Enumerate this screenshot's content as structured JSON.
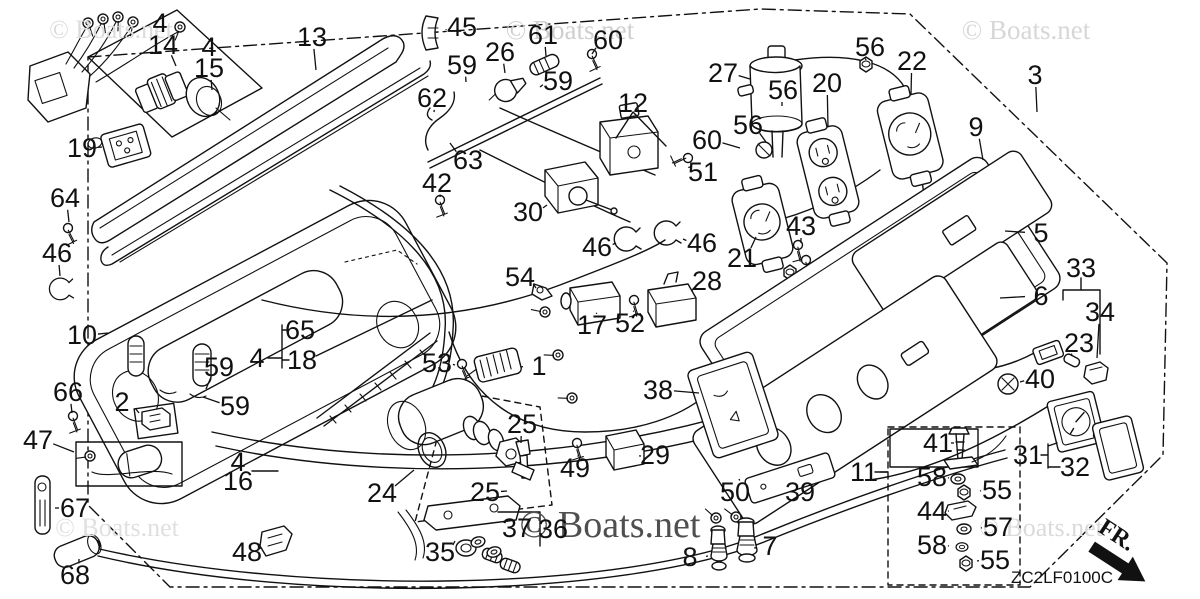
{
  "canvas": {
    "width": 1200,
    "height": 599,
    "background": "#ffffff",
    "ink_color": "#111111"
  },
  "watermarks": [
    {
      "text": "© Boats.net",
      "x": 111,
      "y": 38,
      "size": 26,
      "color": "#dcdcdc"
    },
    {
      "text": "© Boats.net",
      "x": 570,
      "y": 39,
      "size": 27,
      "color": "#cfcfcf"
    },
    {
      "text": "© Boats.net",
      "x": 1026,
      "y": 39,
      "size": 27,
      "color": "#d7d7d7"
    },
    {
      "text": "© Boats.net",
      "x": 117,
      "y": 536,
      "size": 26,
      "color": "#e0e0e0"
    },
    {
      "text": "© Boats.net",
      "x": 610,
      "y": 537,
      "size": 38,
      "color": "#4f4f4f"
    },
    {
      "text": "© Boats.net",
      "x": 1041,
      "y": 536,
      "size": 26,
      "color": "#dadada"
    }
  ],
  "footer": {
    "diagram_code": "ZC2LF0100C",
    "code_x": 1062,
    "code_y": 583,
    "fr_label": "FR.",
    "fr_x": 1097,
    "fr_y": 531,
    "fr_angle": 33
  },
  "part_labels": [
    {
      "t": "4",
      "x": 160,
      "y": 23
    },
    {
      "t": "14",
      "x": 163,
      "y": 45,
      "l": [
        176,
        66
      ]
    },
    {
      "t": "4",
      "x": 209,
      "y": 47
    },
    {
      "t": "15",
      "x": 209,
      "y": 68,
      "l": [
        212,
        90
      ]
    },
    {
      "t": "13",
      "x": 312,
      "y": 37,
      "l": [
        316,
        70
      ]
    },
    {
      "t": "45",
      "x": 462,
      "y": 27,
      "l": [
        446,
        30
      ]
    },
    {
      "t": "61",
      "x": 543,
      "y": 35,
      "l": [
        546,
        56
      ]
    },
    {
      "t": "60",
      "x": 608,
      "y": 40,
      "l": [
        592,
        54
      ]
    },
    {
      "t": "26",
      "x": 500,
      "y": 52,
      "l": [
        505,
        73
      ]
    },
    {
      "t": "59",
      "x": 462,
      "y": 65,
      "l": [
        466,
        82
      ]
    },
    {
      "t": "59",
      "x": 558,
      "y": 81,
      "l": [
        540,
        87
      ]
    },
    {
      "t": "27",
      "x": 723,
      "y": 73,
      "l": [
        750,
        79
      ]
    },
    {
      "t": "56",
      "x": 870,
      "y": 47,
      "l": [
        866,
        60
      ]
    },
    {
      "t": "22",
      "x": 912,
      "y": 61,
      "l": [
        911,
        94
      ]
    },
    {
      "t": "3",
      "x": 1035,
      "y": 75,
      "l": [
        1037,
        112
      ]
    },
    {
      "t": "20",
      "x": 827,
      "y": 83,
      "l": [
        828,
        127
      ]
    },
    {
      "t": "56",
      "x": 783,
      "y": 90,
      "l": [
        782,
        106
      ]
    },
    {
      "t": "62",
      "x": 432,
      "y": 98,
      "l": [
        434,
        112
      ]
    },
    {
      "t": "12",
      "x": 633,
      "y": 103
    },
    {
      "t": "56",
      "x": 748,
      "y": 125,
      "l": [
        766,
        142
      ]
    },
    {
      "t": "9",
      "x": 976,
      "y": 127,
      "l": [
        983,
        160
      ]
    },
    {
      "t": "60",
      "x": 707,
      "y": 140,
      "l": [
        740,
        148
      ]
    },
    {
      "t": "19",
      "x": 82,
      "y": 148,
      "l": [
        102,
        147
      ]
    },
    {
      "t": "63",
      "x": 468,
      "y": 160,
      "l": [
        450,
        143
      ]
    },
    {
      "t": "51",
      "x": 703,
      "y": 172,
      "l": [
        691,
        167
      ]
    },
    {
      "t": "42",
      "x": 437,
      "y": 183,
      "l": [
        440,
        197
      ]
    },
    {
      "t": "64",
      "x": 65,
      "y": 198,
      "l": [
        69,
        222
      ]
    },
    {
      "t": "30",
      "x": 528,
      "y": 212,
      "l": [
        547,
        205
      ]
    },
    {
      "t": "43",
      "x": 801,
      "y": 226,
      "l": [
        801,
        243
      ]
    },
    {
      "t": "5",
      "x": 1041,
      "y": 233,
      "l": [
        1005,
        231
      ]
    },
    {
      "t": "46",
      "x": 57,
      "y": 253,
      "l": [
        60,
        276
      ]
    },
    {
      "t": "46",
      "x": 597,
      "y": 247,
      "l": [
        616,
        243
      ]
    },
    {
      "t": "46",
      "x": 702,
      "y": 243,
      "l": [
        683,
        239
      ]
    },
    {
      "t": "21",
      "x": 742,
      "y": 258,
      "l": [
        756,
        237
      ]
    },
    {
      "t": "33",
      "x": 1081,
      "y": 268
    },
    {
      "t": "54",
      "x": 520,
      "y": 277,
      "l": [
        536,
        288
      ]
    },
    {
      "t": "28",
      "x": 707,
      "y": 281,
      "l": [
        692,
        291
      ]
    },
    {
      "t": "6",
      "x": 1041,
      "y": 296,
      "l": [
        1000,
        298
      ]
    },
    {
      "t": "34",
      "x": 1100,
      "y": 312,
      "l": [
        1097,
        358
      ]
    },
    {
      "t": "17",
      "x": 592,
      "y": 325,
      "l": [
        596,
        313
      ]
    },
    {
      "t": "52",
      "x": 630,
      "y": 323,
      "l": [
        633,
        311
      ]
    },
    {
      "t": "65",
      "x": 300,
      "y": 330
    },
    {
      "t": "10",
      "x": 82,
      "y": 335,
      "l": [
        108,
        333
      ]
    },
    {
      "t": "23",
      "x": 1079,
      "y": 343,
      "l": [
        1072,
        356
      ]
    },
    {
      "t": "4",
      "x": 257,
      "y": 358
    },
    {
      "t": "18",
      "x": 302,
      "y": 360
    },
    {
      "t": "53",
      "x": 437,
      "y": 363,
      "l": [
        455,
        365
      ]
    },
    {
      "t": "1",
      "x": 539,
      "y": 366,
      "l": [
        521,
        367
      ]
    },
    {
      "t": "59",
      "x": 219,
      "y": 367,
      "l": [
        206,
        389
      ]
    },
    {
      "t": "40",
      "x": 1040,
      "y": 379,
      "l": [
        1020,
        382
      ]
    },
    {
      "t": "38",
      "x": 658,
      "y": 390,
      "l": [
        699,
        393
      ]
    },
    {
      "t": "66",
      "x": 68,
      "y": 392,
      "l": [
        72,
        413
      ]
    },
    {
      "t": "2",
      "x": 122,
      "y": 402,
      "l": [
        139,
        413
      ]
    },
    {
      "t": "59",
      "x": 235,
      "y": 406,
      "l": [
        203,
        397
      ]
    },
    {
      "t": "25",
      "x": 522,
      "y": 424,
      "l": [
        521,
        443
      ]
    },
    {
      "t": "47",
      "x": 38,
      "y": 440,
      "l": [
        74,
        452
      ]
    },
    {
      "t": "41",
      "x": 938,
      "y": 443,
      "l": [
        951,
        443
      ]
    },
    {
      "t": "31",
      "x": 1028,
      "y": 455
    },
    {
      "t": "29",
      "x": 655,
      "y": 455,
      "l": [
        641,
        456
      ]
    },
    {
      "t": "4",
      "x": 238,
      "y": 462
    },
    {
      "t": "16",
      "x": 238,
      "y": 481
    },
    {
      "t": "32",
      "x": 1075,
      "y": 467
    },
    {
      "t": "49",
      "x": 575,
      "y": 468,
      "l": [
        577,
        456
      ]
    },
    {
      "t": "11",
      "x": 864,
      "y": 472,
      "l": [
        888,
        472
      ]
    },
    {
      "t": "58",
      "x": 932,
      "y": 477,
      "l": [
        949,
        478
      ]
    },
    {
      "t": "55",
      "x": 997,
      "y": 490,
      "l": [
        980,
        491
      ]
    },
    {
      "t": "25",
      "x": 485,
      "y": 492,
      "l": [
        507,
        491
      ]
    },
    {
      "t": "39",
      "x": 800,
      "y": 492
    },
    {
      "t": "50",
      "x": 735,
      "y": 492,
      "l": [
        739,
        479
      ]
    },
    {
      "t": "24",
      "x": 382,
      "y": 493,
      "l": [
        414,
        470
      ]
    },
    {
      "t": "67",
      "x": 75,
      "y": 508,
      "l": [
        55,
        508
      ]
    },
    {
      "t": "44",
      "x": 932,
      "y": 511,
      "l": [
        949,
        511
      ]
    },
    {
      "t": "57",
      "x": 998,
      "y": 527,
      "l": [
        981,
        528
      ]
    },
    {
      "t": "37",
      "x": 517,
      "y": 528
    },
    {
      "t": "36",
      "x": 553,
      "y": 529
    },
    {
      "t": "7",
      "x": 770,
      "y": 546,
      "l": [
        757,
        548
      ]
    },
    {
      "t": "58",
      "x": 932,
      "y": 545,
      "l": [
        949,
        546
      ]
    },
    {
      "t": "35",
      "x": 440,
      "y": 552,
      "l": [
        455,
        541
      ]
    },
    {
      "t": "48",
      "x": 247,
      "y": 552,
      "l": [
        260,
        548
      ]
    },
    {
      "t": "8",
      "x": 690,
      "y": 557,
      "l": [
        708,
        556
      ]
    },
    {
      "t": "55",
      "x": 995,
      "y": 560,
      "l": [
        977,
        561
      ]
    },
    {
      "t": "68",
      "x": 75,
      "y": 575,
      "l": [
        79,
        559
      ]
    }
  ]
}
